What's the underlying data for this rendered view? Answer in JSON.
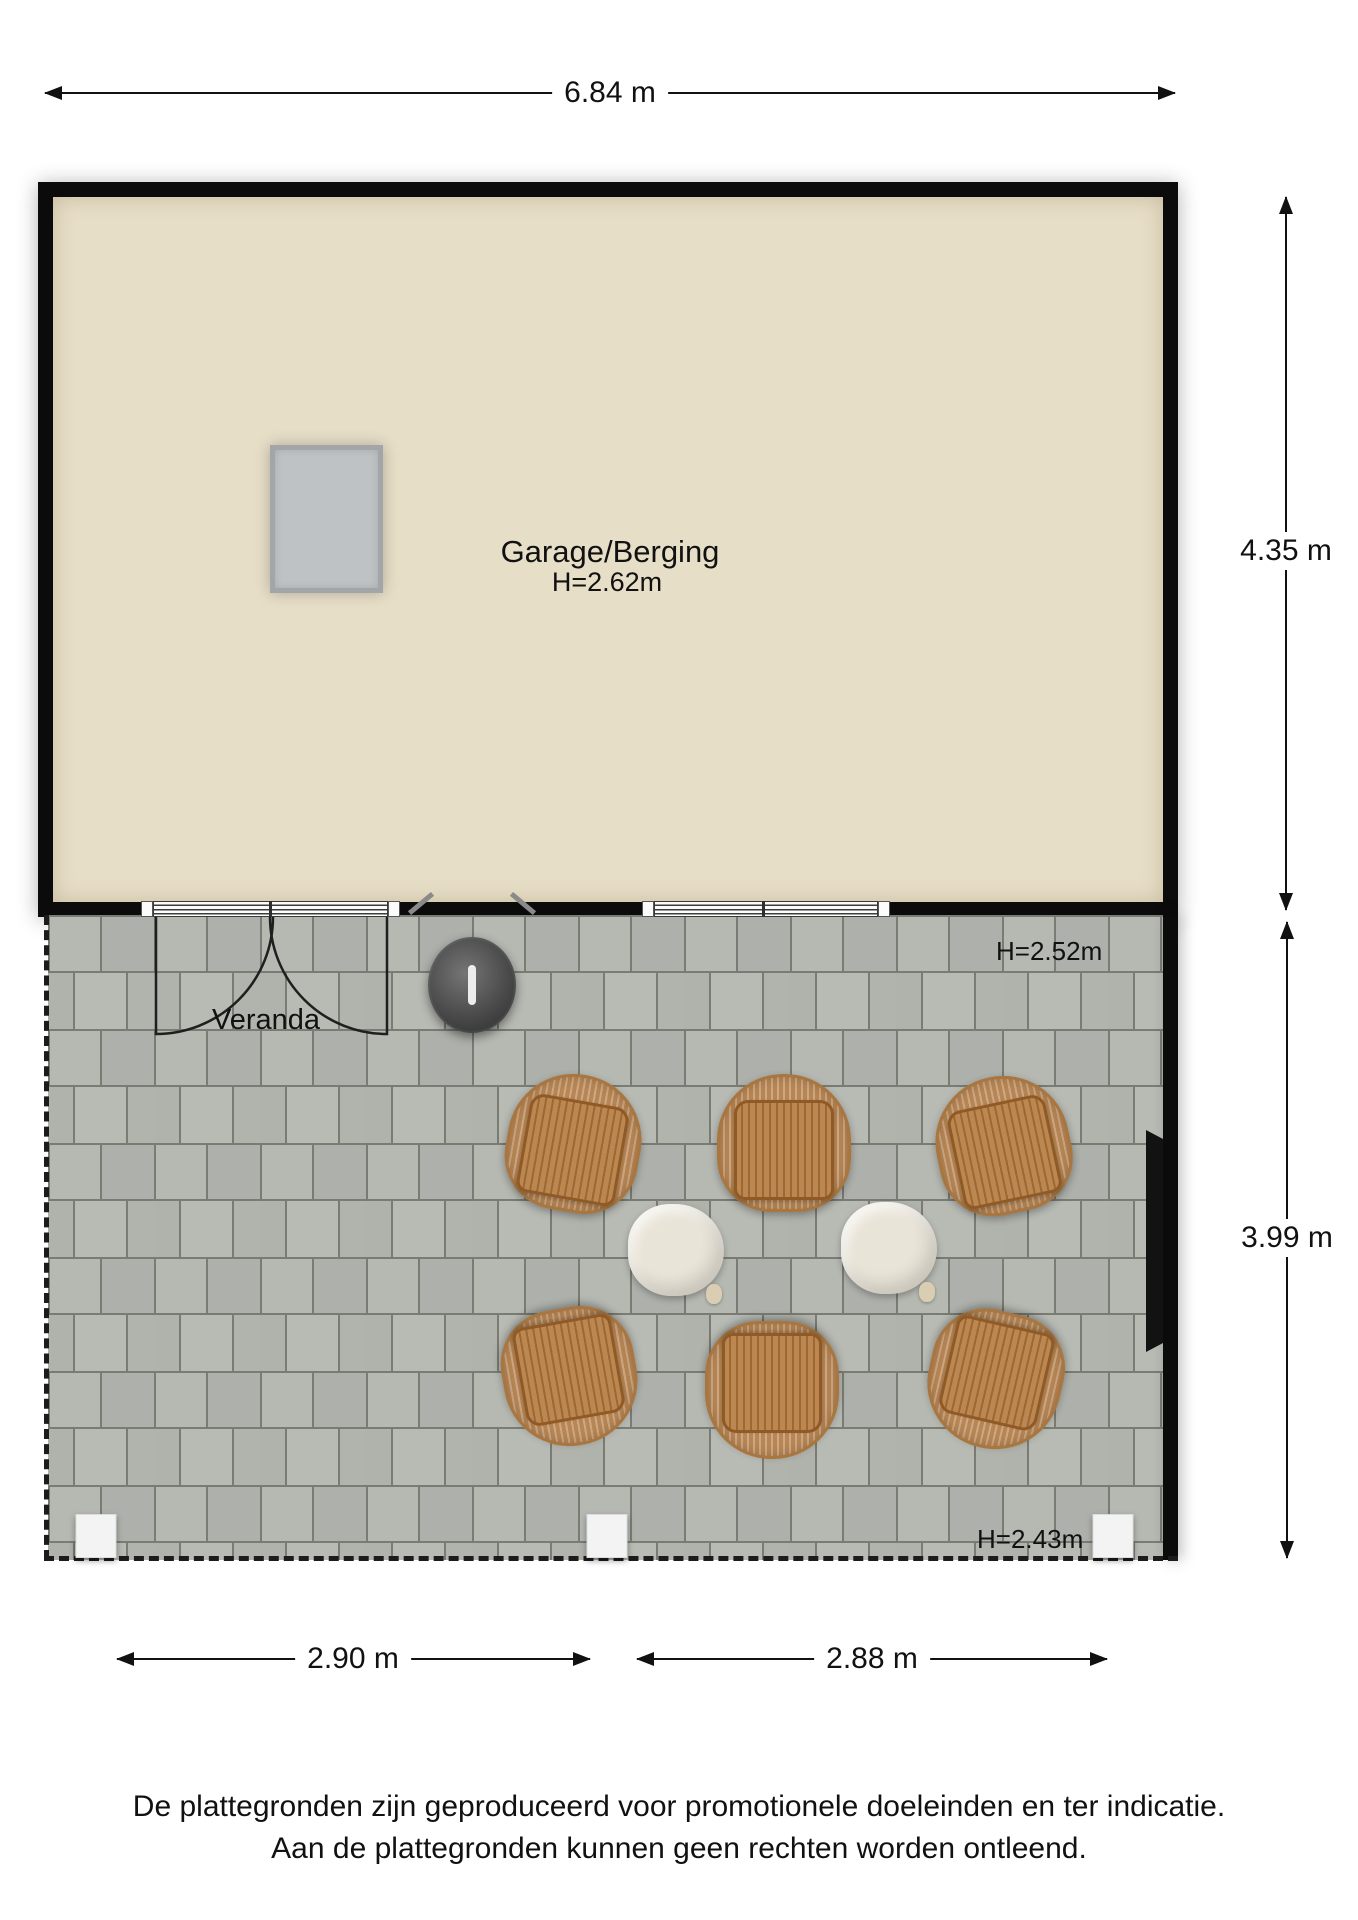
{
  "labels": {
    "garage_name": "Garage/Berging",
    "garage_height": "H=2.62m",
    "veranda_name": "Veranda",
    "veranda_height_top": "H=2.52m",
    "veranda_height_bottom": "H=2.43m"
  },
  "dimensions": {
    "top_width": "6.84 m",
    "garage_depth": "4.35 m",
    "veranda_depth": "3.99 m",
    "veranda_bottom_left": "2.90 m",
    "veranda_bottom_right": "2.88 m"
  },
  "footer": {
    "line1": "De plattegronden zijn geproduceerd voor promotionele doeleinden en ter indicatie.",
    "line2": "Aan de plattegronden kunnen geen rechten worden ontleend."
  },
  "colors": {
    "wall": "#0b0b0b",
    "garage_floor": "#e7dec7",
    "tile": "#b3b5af",
    "tile_grout": "#7a7c74",
    "wicker": "#c2905e",
    "seat_wood": "#b5793c",
    "table": "#e9e4d8",
    "bbq": "#4a4a4a",
    "post": "#f3f3f3"
  },
  "furniture": {
    "chairs": [
      {
        "x": 574,
        "y": 1143,
        "rot": 10
      },
      {
        "x": 784,
        "y": 1143,
        "rot": 0
      },
      {
        "x": 1003,
        "y": 1145,
        "rot": -12
      },
      {
        "x": 570,
        "y": 1377,
        "rot": 170
      },
      {
        "x": 772,
        "y": 1390,
        "rot": 180
      },
      {
        "x": 995,
        "y": 1380,
        "rot": 193
      }
    ],
    "tables": [
      {
        "x": 676,
        "y": 1250
      },
      {
        "x": 889,
        "y": 1248
      }
    ],
    "bbq": {
      "x": 472,
      "y": 985
    },
    "posts": [
      {
        "x": 96,
        "y": 1536
      },
      {
        "x": 607,
        "y": 1536
      },
      {
        "x": 1113,
        "y": 1536
      }
    ]
  }
}
